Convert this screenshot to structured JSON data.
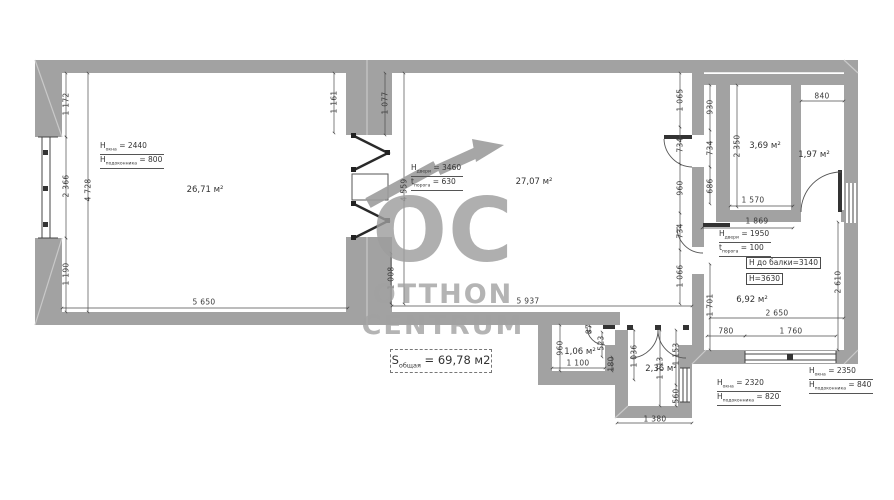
{
  "watermark": {
    "logo": "OC",
    "line1": "OTTHON",
    "line2": "CENTRUM"
  },
  "total_area": {
    "main": "S",
    "sub": "общая",
    "rest": " = 69,78 м2"
  },
  "rooms": [
    {
      "area": "26,71 м²",
      "x": 205,
      "y": 190
    },
    {
      "area": "27,07 м²",
      "x": 534,
      "y": 182
    },
    {
      "area": "3,69 м²",
      "x": 765,
      "y": 146
    },
    {
      "area": "1,97 м²",
      "x": 814,
      "y": 155
    },
    {
      "area": "6,92 м²",
      "x": 752,
      "y": 300
    },
    {
      "area": "1,06 м²",
      "x": 580,
      "y": 352
    },
    {
      "area": "2,36 м²",
      "x": 661,
      "y": 369
    }
  ],
  "dimensions": [
    {
      "text": "1 172",
      "x": 66,
      "y": 104,
      "rot": true
    },
    {
      "text": "2 366",
      "x": 66,
      "y": 186,
      "rot": true
    },
    {
      "text": "1 190",
      "x": 66,
      "y": 274,
      "rot": true
    },
    {
      "text": "4 728",
      "x": 88,
      "y": 190,
      "rot": true
    },
    {
      "text": "1 161",
      "x": 334,
      "y": 102,
      "rot": true
    },
    {
      "text": "5 650",
      "x": 204,
      "y": 302,
      "rot": false
    },
    {
      "text": "1 077",
      "x": 385,
      "y": 103,
      "rot": true
    },
    {
      "text": "4 559",
      "x": 404,
      "y": 190,
      "rot": true
    },
    {
      "text": "1 008",
      "x": 391,
      "y": 278,
      "rot": true
    },
    {
      "text": "5 937",
      "x": 528,
      "y": 301,
      "rot": false
    },
    {
      "text": "1 065",
      "x": 680,
      "y": 100,
      "rot": true
    },
    {
      "text": "734",
      "x": 680,
      "y": 145,
      "rot": true
    },
    {
      "text": "960",
      "x": 680,
      "y": 188,
      "rot": true
    },
    {
      "text": "734",
      "x": 680,
      "y": 231,
      "rot": true
    },
    {
      "text": "1 066",
      "x": 680,
      "y": 276,
      "rot": true
    },
    {
      "text": "930",
      "x": 710,
      "y": 107,
      "rot": true
    },
    {
      "text": "734",
      "x": 710,
      "y": 148,
      "rot": true
    },
    {
      "text": "686",
      "x": 710,
      "y": 186,
      "rot": true
    },
    {
      "text": "2 350",
      "x": 737,
      "y": 146,
      "rot": true
    },
    {
      "text": "840",
      "x": 822,
      "y": 96,
      "rot": false
    },
    {
      "text": "1 570",
      "x": 753,
      "y": 200,
      "rot": false
    },
    {
      "text": "1 869",
      "x": 757,
      "y": 221,
      "rot": false
    },
    {
      "text": "2 610",
      "x": 838,
      "y": 282,
      "rot": true
    },
    {
      "text": "1 701",
      "x": 710,
      "y": 305,
      "rot": true
    },
    {
      "text": "2 650",
      "x": 777,
      "y": 313,
      "rot": false
    },
    {
      "text": "780",
      "x": 726,
      "y": 331,
      "rot": false
    },
    {
      "text": "1 760",
      "x": 791,
      "y": 331,
      "rot": false
    },
    {
      "text": "960",
      "x": 560,
      "y": 348,
      "rot": true
    },
    {
      "text": "87",
      "x": 589,
      "y": 329,
      "rot": true
    },
    {
      "text": "523",
      "x": 601,
      "y": 343,
      "rot": true
    },
    {
      "text": "1 100",
      "x": 578,
      "y": 363,
      "rot": false
    },
    {
      "text": "180",
      "x": 611,
      "y": 364,
      "rot": true
    },
    {
      "text": "1 036",
      "x": 634,
      "y": 356,
      "rot": true
    },
    {
      "text": "1 713",
      "x": 660,
      "y": 368,
      "rot": true
    },
    {
      "text": "1 153",
      "x": 676,
      "y": 354,
      "rot": true
    },
    {
      "text": "560",
      "x": 676,
      "y": 396,
      "rot": true
    },
    {
      "text": "1 380",
      "x": 655,
      "y": 419,
      "rot": false
    }
  ],
  "height_notes": [
    {
      "x": 100,
      "y": 141,
      "lines": [
        {
          "main": "H",
          "sub": "окна",
          "rest": " = 2440"
        },
        {
          "main": "H",
          "sub": "подоконника",
          "rest": " = 800"
        }
      ]
    },
    {
      "x": 411,
      "y": 163,
      "lines": [
        {
          "main": "H",
          "sub": "двери",
          "rest": " = 3460"
        },
        {
          "main": "t",
          "sub": "порога",
          "rest": " = 630"
        }
      ]
    },
    {
      "x": 719,
      "y": 229,
      "lines": [
        {
          "main": "H",
          "sub": "двери",
          "rest": " = 1950"
        },
        {
          "main": "t",
          "sub": "порога",
          "rest": " = 100"
        }
      ]
    },
    {
      "x": 717,
      "y": 378,
      "lines": [
        {
          "main": "H",
          "sub": "окна",
          "rest": " = 2320"
        },
        {
          "main": "H",
          "sub": "подоконника",
          "rest": " = 820"
        }
      ]
    },
    {
      "x": 809,
      "y": 366,
      "lines": [
        {
          "main": "H",
          "sub": "окна",
          "rest": " = 2350"
        },
        {
          "main": "H",
          "sub": "подоконника",
          "rest": " = 840"
        }
      ]
    }
  ],
  "boxed_notes": [
    {
      "text": "Н до балки=3140",
      "x": 746,
      "y": 257
    },
    {
      "text": "H=3630",
      "x": 746,
      "y": 273
    }
  ],
  "colors": {
    "wall": "#a2a2a2",
    "line": "#4c4c4c",
    "watermark": "#9d9d9d"
  }
}
